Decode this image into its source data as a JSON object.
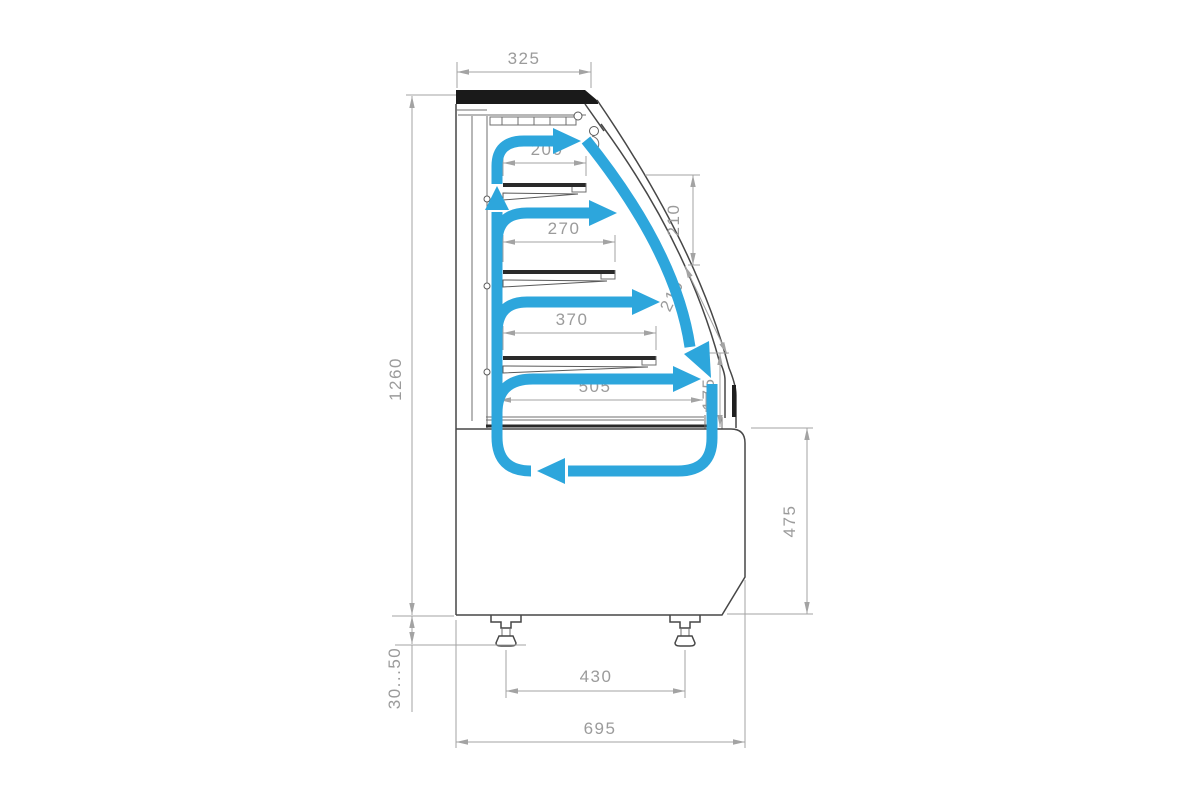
{
  "diagram": {
    "type": "technical-drawing",
    "subject": "refrigerated-display-case-side-section-with-airflow",
    "colors": {
      "background": "#ffffff",
      "outline": "#474747",
      "top_panel": "#1a1a1a",
      "dimension": "#9b9b9b",
      "airflow": "#2da6dc"
    },
    "labels": {
      "top_width": "325",
      "shelf_1_depth": "200",
      "shelf_2_depth": "270",
      "shelf_3_depth": "370",
      "deck_depth": "505",
      "tier_gap_upper": "210",
      "tier_gap_lower": "210",
      "deck_gap": "175",
      "overall_height": "1260",
      "base_height": "475",
      "feet_spacing": "430",
      "overall_depth": "695",
      "foot_adjustment": "30...50"
    }
  }
}
